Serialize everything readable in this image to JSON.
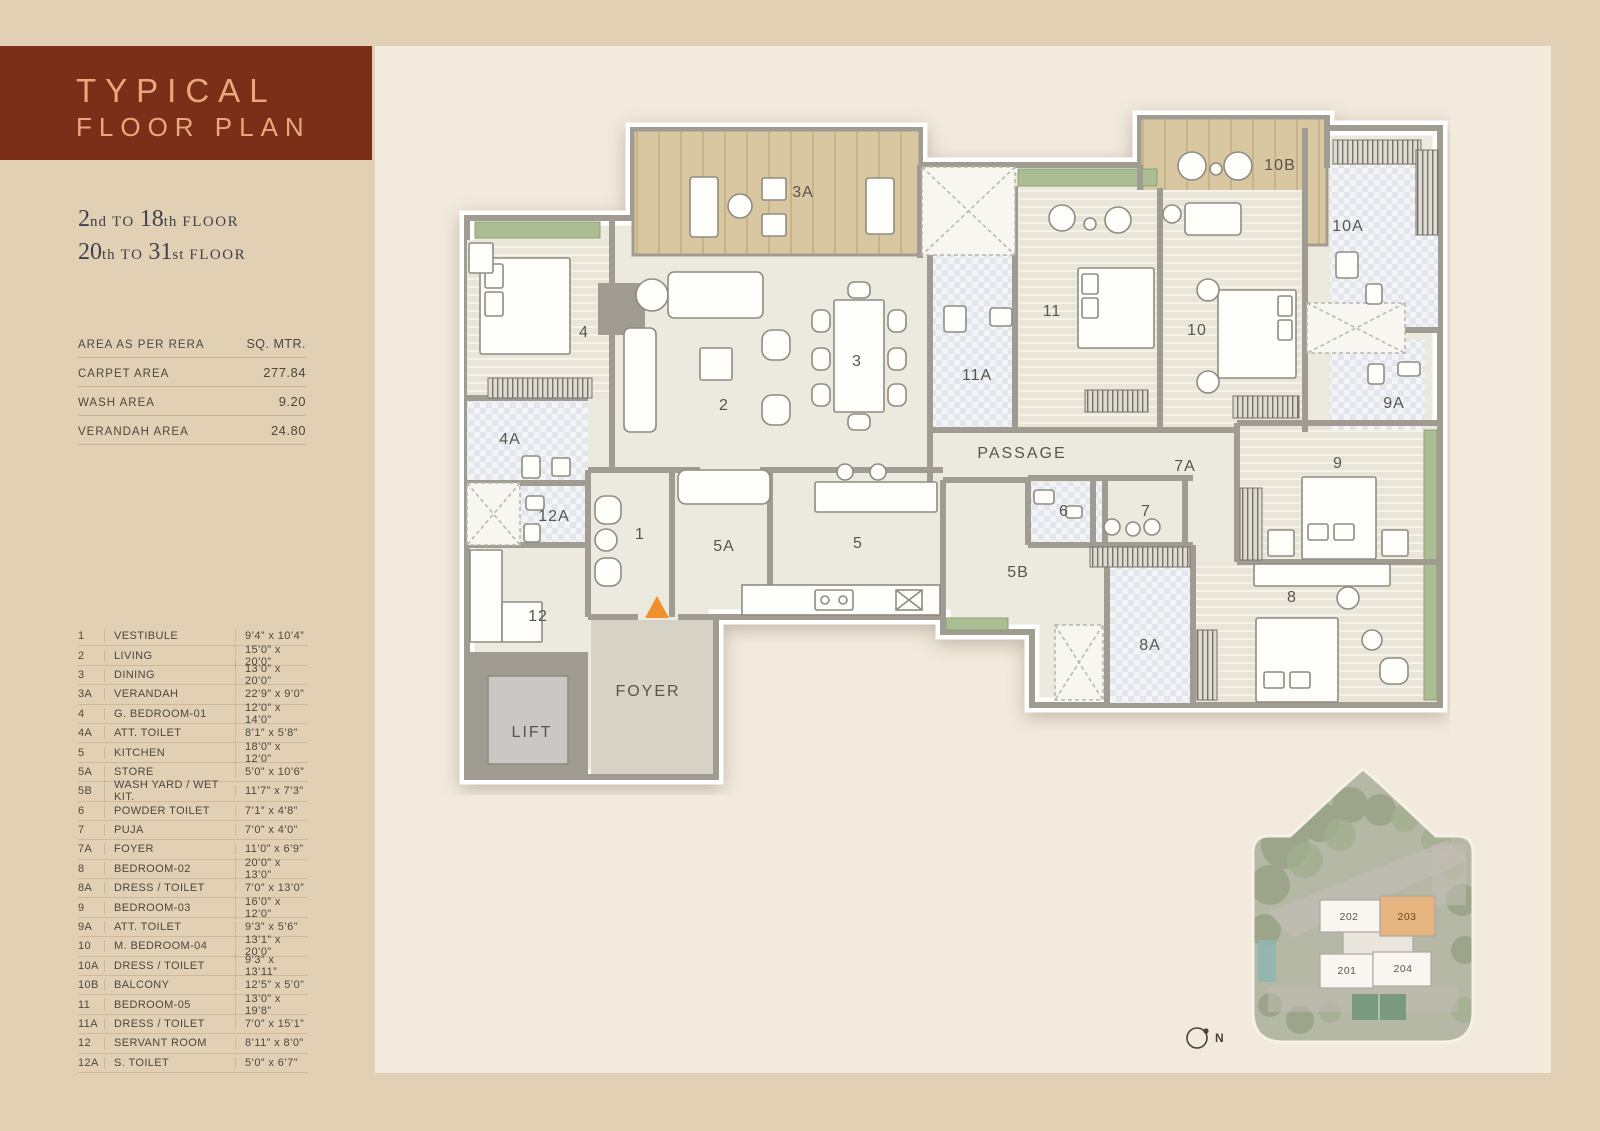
{
  "header": {
    "title_line1": "TYPICAL",
    "title_line2": "FLOOR PLAN"
  },
  "floor_range": [
    {
      "n1": "2",
      "s1": "nd",
      "mid": "TO",
      "n2": "18",
      "s2": "th",
      "tail": "FLOOR"
    },
    {
      "n1": "20",
      "s1": "th",
      "mid": "TO",
      "n2": "31",
      "s2": "st",
      "tail": "FLOOR"
    }
  ],
  "area_table": {
    "header_label": "AREA AS PER RERA",
    "header_unit": "SQ. MTR.",
    "rows": [
      {
        "label": "CARPET AREA",
        "value": "277.84"
      },
      {
        "label": "WASH AREA",
        "value": "9.20"
      },
      {
        "label": "VERANDAH AREA",
        "value": "24.80"
      }
    ]
  },
  "legend": {
    "rows": [
      {
        "id": "1",
        "name": "VESTIBULE",
        "size": "9’4” x 10’4”"
      },
      {
        "id": "2",
        "name": "LIVING",
        "size": "15’0” x 20’0”"
      },
      {
        "id": "3",
        "name": "DINING",
        "size": "13’0” x 20’0”"
      },
      {
        "id": "3A",
        "name": "VERANDAH",
        "size": "22’9” x 9’0”"
      },
      {
        "id": "4",
        "name": "G. BEDROOM-01",
        "size": "12’0” x 14’0”"
      },
      {
        "id": "4A",
        "name": "ATT. TOILET",
        "size": "8’1” x 5’8”"
      },
      {
        "id": "5",
        "name": "KITCHEN",
        "size": "18’0” x 12’0”"
      },
      {
        "id": "5A",
        "name": "STORE",
        "size": "5’0” x 10’6”"
      },
      {
        "id": "5B",
        "name": "WASH YARD / WET KIT.",
        "size": "11’7” x 7’3”"
      },
      {
        "id": "6",
        "name": "POWDER TOILET",
        "size": "7’1” x 4’8”"
      },
      {
        "id": "7",
        "name": "PUJA",
        "size": "7’0” x 4’0”"
      },
      {
        "id": "7A",
        "name": "FOYER",
        "size": "11’0” x 6’9”"
      },
      {
        "id": "8",
        "name": "BEDROOM-02",
        "size": "20’0” x 13’0”"
      },
      {
        "id": "8A",
        "name": "DRESS / TOILET",
        "size": "7’0” x 13’0”"
      },
      {
        "id": "9",
        "name": "BEDROOM-03",
        "size": "16’0” x 12’0”"
      },
      {
        "id": "9A",
        "name": "ATT. TOILET",
        "size": "9’3” x 5’6”"
      },
      {
        "id": "10",
        "name": "M. BEDROOM-04",
        "size": "13’1” x 20’0”"
      },
      {
        "id": "10A",
        "name": "DRESS / TOILET",
        "size": "9’3” x 13’11”"
      },
      {
        "id": "10B",
        "name": "BALCONY",
        "size": "12’5” x 5’0”"
      },
      {
        "id": "11",
        "name": "BEDROOM-05",
        "size": "13’0” x 19’8”"
      },
      {
        "id": "11A",
        "name": "DRESS / TOILET",
        "size": "7’0” x 15’1”"
      },
      {
        "id": "12",
        "name": "SERVANT ROOM",
        "size": "8’11” x 8’0”"
      },
      {
        "id": "12A",
        "name": "S. TOILET",
        "size": "5’0” x 6’7”"
      }
    ]
  },
  "plan": {
    "labels": {
      "r1": "1",
      "r2": "2",
      "r3": "3",
      "r3a": "3A",
      "r4": "4",
      "r4a": "4A",
      "r5": "5",
      "r5a": "5A",
      "r5b": "5B",
      "r6": "6",
      "r7": "7",
      "r7a": "7A",
      "r8": "8",
      "r8a": "8A",
      "r9": "9",
      "r9a": "9A",
      "r10": "10",
      "r10a": "10A",
      "r10b": "10B",
      "r11": "11",
      "r11a": "11A",
      "r12": "12",
      "r12a": "12A",
      "passage": "PASSAGE",
      "foyer": "FOYER",
      "lift": "LIFT"
    }
  },
  "site_plan": {
    "units": [
      {
        "id": "202"
      },
      {
        "id": "203"
      },
      {
        "id": "201"
      },
      {
        "id": "204"
      }
    ],
    "highlight_unit": "203",
    "north_label": "N"
  },
  "colors": {
    "page_bg": "#e2d0b4",
    "panel_bg": "#f2eadd",
    "title_block_bg": "#7b2e18",
    "title_text": "#e9a87c",
    "body_text": "#3f434b",
    "wall_gray": "#a19c92",
    "floor": "#eceade",
    "verandah_tan": "#d9c7a1",
    "window_green": "#abbe93",
    "entrance_orange": "#ef8f2d",
    "unit_highlight": "#e2a665"
  }
}
